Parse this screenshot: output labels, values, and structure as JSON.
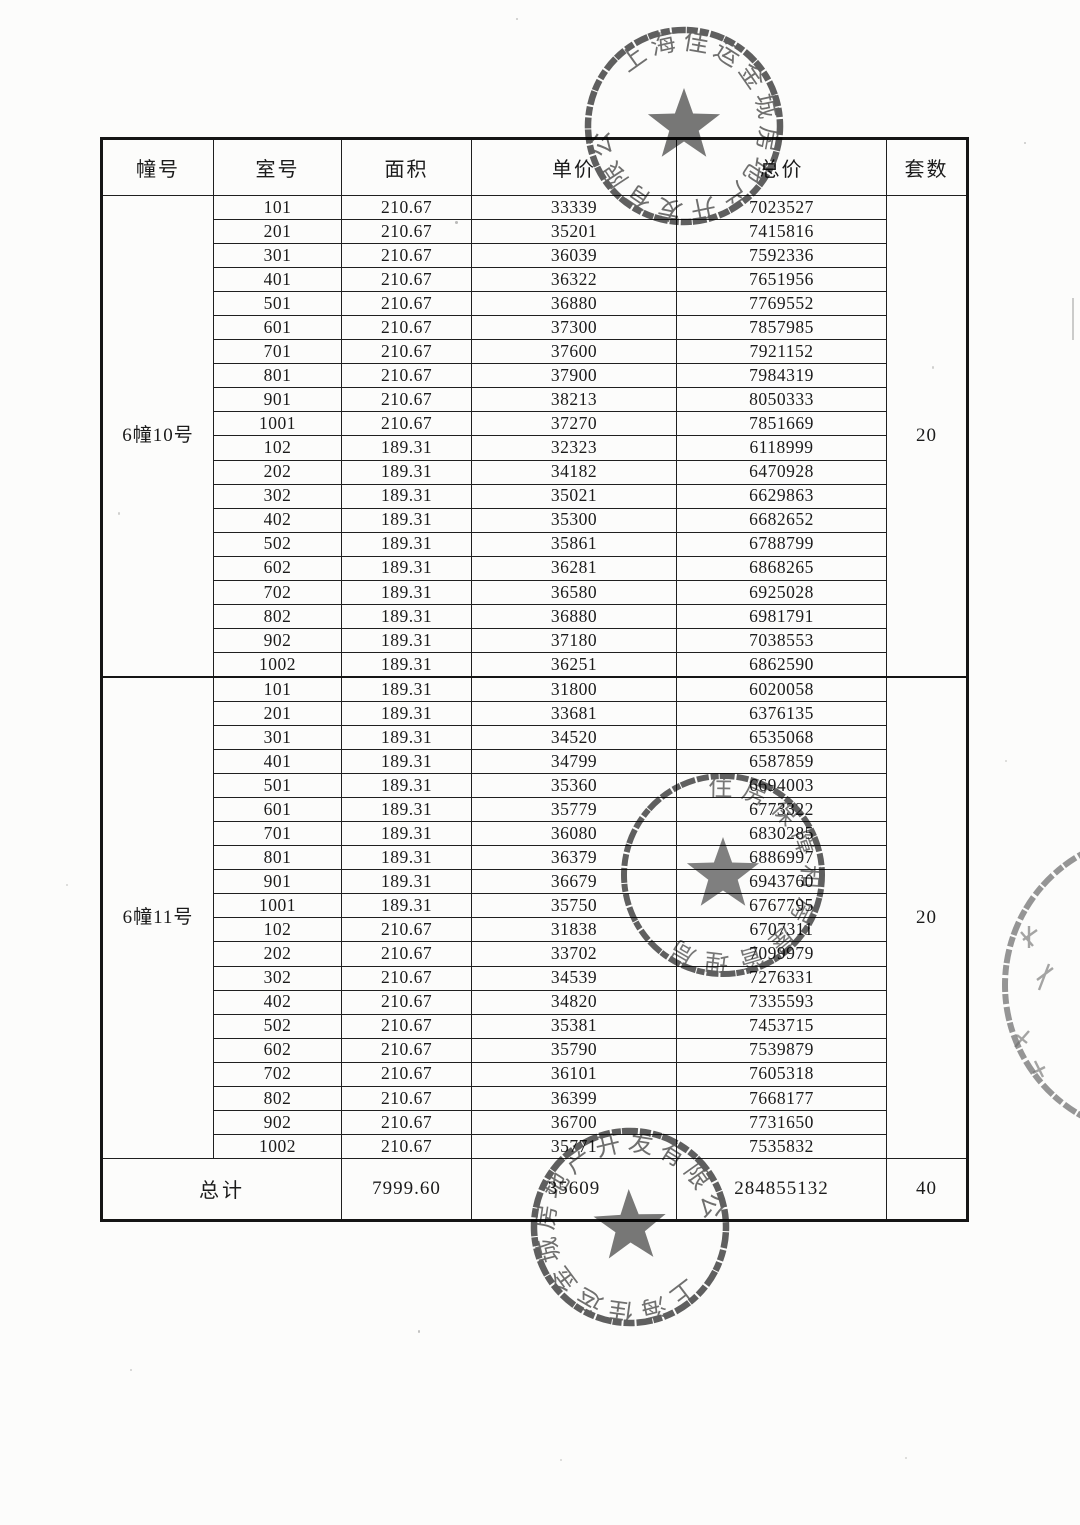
{
  "table": {
    "headers": [
      "幢号",
      "室号",
      "面积",
      "单价",
      "总价",
      "套数"
    ],
    "sections": [
      {
        "building": "6幢10号",
        "unit_count": "20",
        "rows": [
          [
            "101",
            "210.67",
            "33339",
            "7023527"
          ],
          [
            "201",
            "210.67",
            "35201",
            "7415816"
          ],
          [
            "301",
            "210.67",
            "36039",
            "7592336"
          ],
          [
            "401",
            "210.67",
            "36322",
            "7651956"
          ],
          [
            "501",
            "210.67",
            "36880",
            "7769552"
          ],
          [
            "601",
            "210.67",
            "37300",
            "7857985"
          ],
          [
            "701",
            "210.67",
            "37600",
            "7921152"
          ],
          [
            "801",
            "210.67",
            "37900",
            "7984319"
          ],
          [
            "901",
            "210.67",
            "38213",
            "8050333"
          ],
          [
            "1001",
            "210.67",
            "37270",
            "7851669"
          ],
          [
            "102",
            "189.31",
            "32323",
            "6118999"
          ],
          [
            "202",
            "189.31",
            "34182",
            "6470928"
          ],
          [
            "302",
            "189.31",
            "35021",
            "6629863"
          ],
          [
            "402",
            "189.31",
            "35300",
            "6682652"
          ],
          [
            "502",
            "189.31",
            "35861",
            "6788799"
          ],
          [
            "602",
            "189.31",
            "36281",
            "6868265"
          ],
          [
            "702",
            "189.31",
            "36580",
            "6925028"
          ],
          [
            "802",
            "189.31",
            "36880",
            "6981791"
          ],
          [
            "902",
            "189.31",
            "37180",
            "7038553"
          ],
          [
            "1002",
            "189.31",
            "36251",
            "6862590"
          ]
        ]
      },
      {
        "building": "6幢11号",
        "unit_count": "20",
        "rows": [
          [
            "101",
            "189.31",
            "31800",
            "6020058"
          ],
          [
            "201",
            "189.31",
            "33681",
            "6376135"
          ],
          [
            "301",
            "189.31",
            "34520",
            "6535068"
          ],
          [
            "401",
            "189.31",
            "34799",
            "6587859"
          ],
          [
            "501",
            "189.31",
            "35360",
            "6694003"
          ],
          [
            "601",
            "189.31",
            "35779",
            "6773322"
          ],
          [
            "701",
            "189.31",
            "36080",
            "6830285"
          ],
          [
            "801",
            "189.31",
            "36379",
            "6886997"
          ],
          [
            "901",
            "189.31",
            "36679",
            "6943760"
          ],
          [
            "1001",
            "189.31",
            "35750",
            "6767795"
          ],
          [
            "102",
            "210.67",
            "31838",
            "6707311"
          ],
          [
            "202",
            "210.67",
            "33702",
            "7099979"
          ],
          [
            "302",
            "210.67",
            "34539",
            "7276331"
          ],
          [
            "402",
            "210.67",
            "34820",
            "7335593"
          ],
          [
            "502",
            "210.67",
            "35381",
            "7453715"
          ],
          [
            "602",
            "210.67",
            "35790",
            "7539879"
          ],
          [
            "702",
            "210.67",
            "36101",
            "7605318"
          ],
          [
            "802",
            "210.67",
            "36399",
            "7668177"
          ],
          [
            "902",
            "210.67",
            "36700",
            "7731650"
          ],
          [
            "1002",
            "210.67",
            "35771",
            "7535832"
          ]
        ]
      }
    ],
    "total": {
      "label": "总计",
      "area": "7999.60",
      "unit_price": "35609",
      "total_price": "284855132",
      "unit_count": "40"
    }
  },
  "stamps": [
    {
      "name": "company-seal-top",
      "text": "上海佳运金城房地产开发有限公司"
    },
    {
      "name": "bureau-seal-middle",
      "text": "住房保障和房屋管理局"
    },
    {
      "name": "company-seal-bottom",
      "text": "上海佳运金城房地产开发有限公司"
    }
  ],
  "colors": {
    "ink": "#1b1b1b",
    "stamp": "#3d3d3d",
    "paper": "#fcfcfb"
  }
}
